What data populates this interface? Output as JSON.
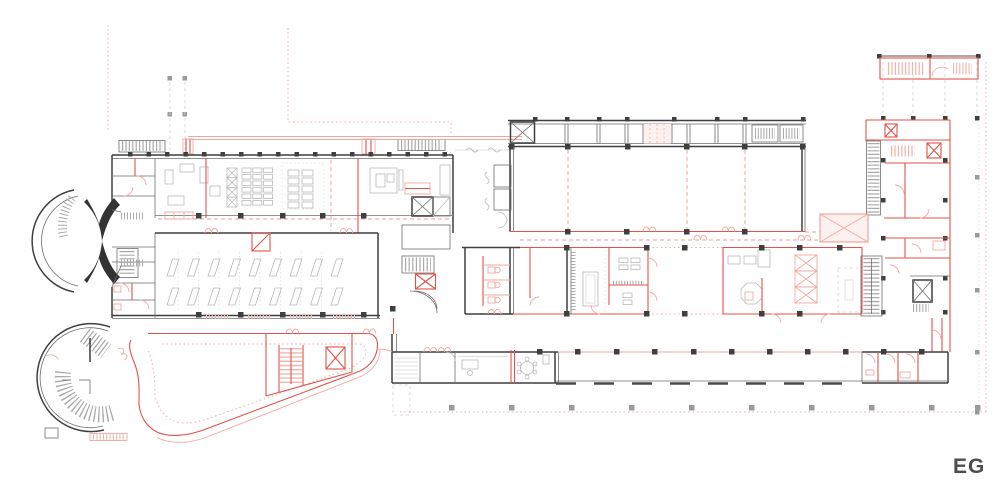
{
  "page": {
    "background_color": "#ffffff"
  },
  "plan": {
    "floor_label": "EG",
    "label_color": "#4d4d4d",
    "colors": {
      "existing_walls": "#3f3f3f",
      "thin_walls": "#6e6e6e",
      "furniture_gray": "#b9b9b9",
      "new_construction_red": "#e0524a",
      "light_red": "#f2a8a2",
      "red_dotted_guides": "#efaaa4",
      "gray_dashed_guides": "#d8d8d8",
      "stair_tread_gray": "#a9a9a9",
      "stair_tread_red": "#f0b5af"
    }
  }
}
